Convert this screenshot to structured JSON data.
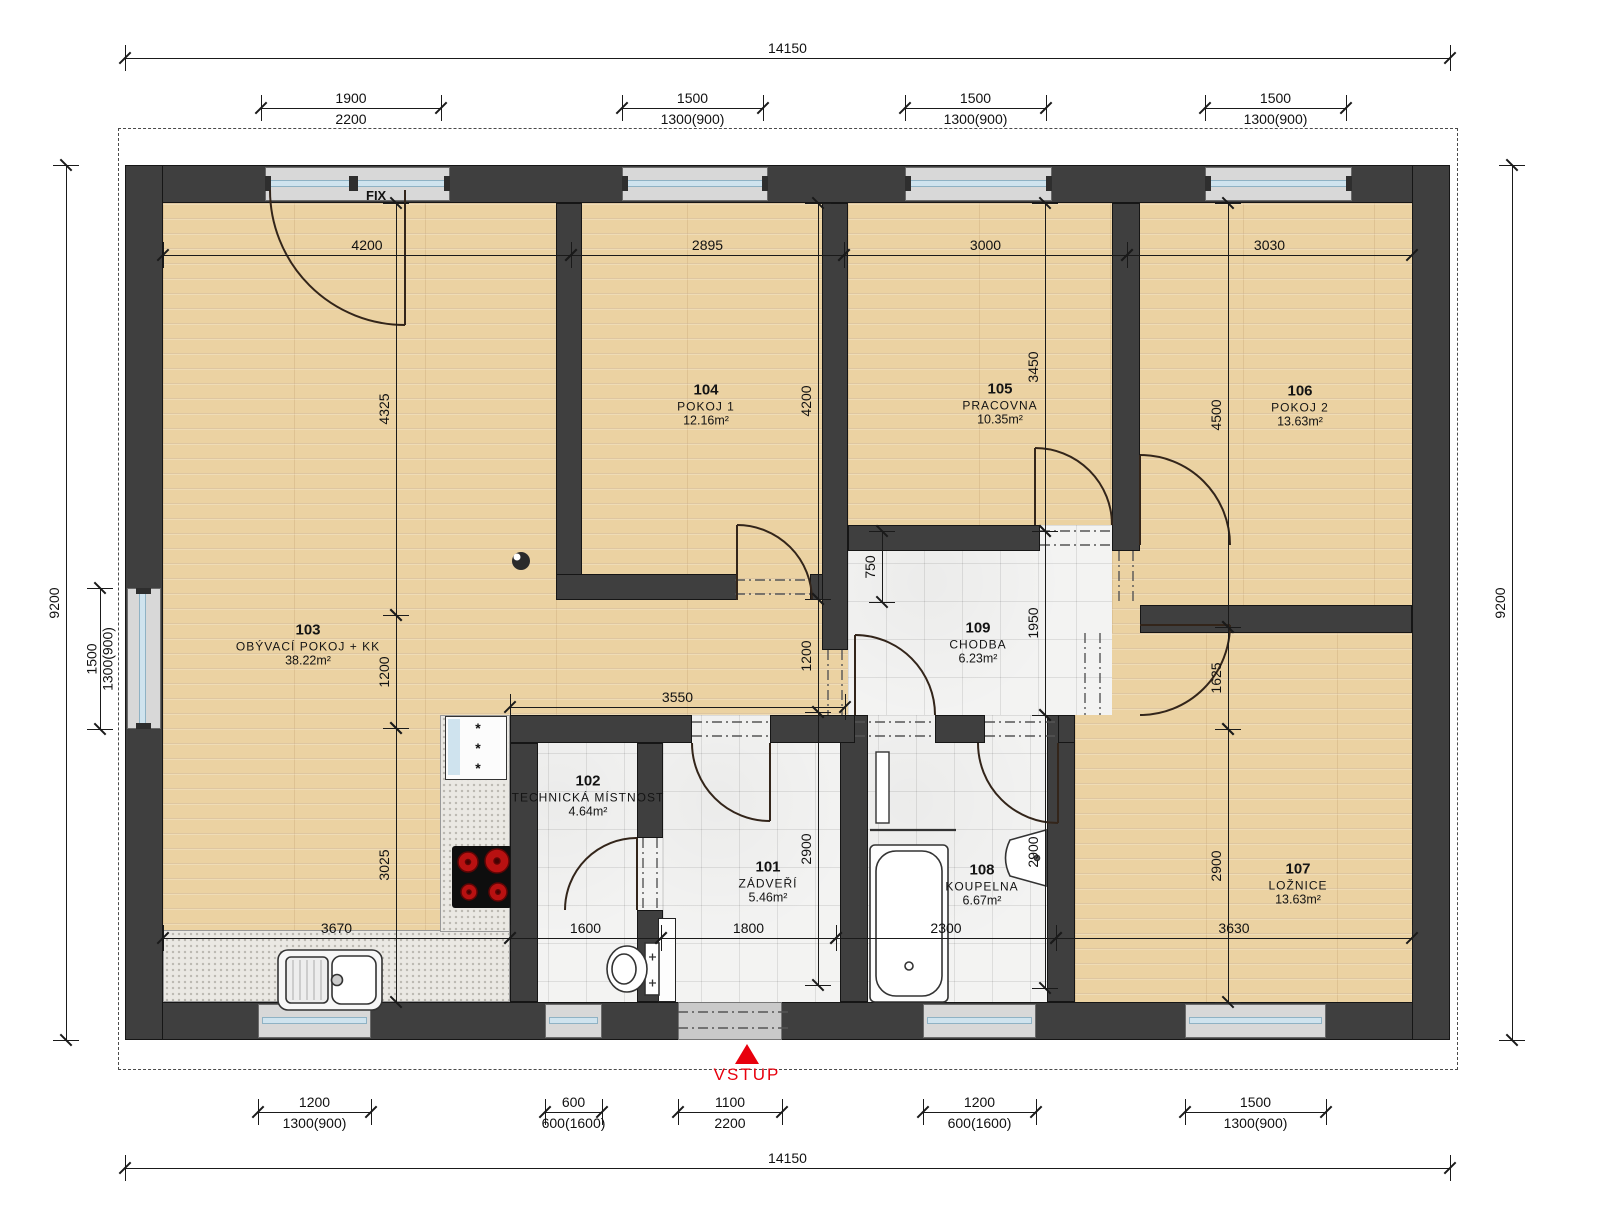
{
  "annotations": {
    "fix": "FIX",
    "vstup": "VSTUP",
    "fridge_symbol": "***"
  },
  "colors": {
    "wall": "#3f3f3f",
    "wood_floor": "#ebd2a2",
    "tile_floor": "#f3f3f2",
    "window_glass": "#cfe3ee",
    "entrance_red": "#e8000d",
    "dimension_text": "#111111"
  },
  "rooms": [
    {
      "num": "101",
      "name": "ZÁDVEŘÍ",
      "area": "5.46m²",
      "x": 768,
      "y": 882
    },
    {
      "num": "102",
      "name": "TECHNICKÁ MÍSTNOST",
      "area": "4.64m²",
      "x": 588,
      "y": 796
    },
    {
      "num": "103",
      "name": "OBÝVACÍ POKOJ + KK",
      "area": "38.22m²",
      "x": 308,
      "y": 645
    },
    {
      "num": "104",
      "name": "POKOJ 1",
      "area": "12.16m²",
      "x": 706,
      "y": 405
    },
    {
      "num": "105",
      "name": "PRACOVNA",
      "area": "10.35m²",
      "x": 1000,
      "y": 404
    },
    {
      "num": "106",
      "name": "POKOJ 2",
      "area": "13.63m²",
      "x": 1300,
      "y": 406
    },
    {
      "num": "107",
      "name": "LOŽNICE",
      "area": "13.63m²",
      "x": 1298,
      "y": 884
    },
    {
      "num": "108",
      "name": "KOUPELNA",
      "area": "6.67m²",
      "x": 982,
      "y": 885
    },
    {
      "num": "109",
      "name": "CHODBA",
      "area": "6.23m²",
      "x": 978,
      "y": 643
    }
  ],
  "dims": [
    {
      "o": "h",
      "x": 125,
      "y": 58,
      "len": 1325,
      "t1": "14150"
    },
    {
      "o": "h",
      "x": 261,
      "y": 108,
      "len": 180,
      "t1": "1900",
      "t2": "2200"
    },
    {
      "o": "h",
      "x": 622,
      "y": 108,
      "len": 141,
      "t1": "1500",
      "t2": "1300(900)"
    },
    {
      "o": "h",
      "x": 905,
      "y": 108,
      "len": 141,
      "t1": "1500",
      "t2": "1300(900)"
    },
    {
      "o": "h",
      "x": 1205,
      "y": 108,
      "len": 141,
      "t1": "1500",
      "t2": "1300(900)"
    },
    {
      "o": "h",
      "x": 163,
      "y": 255,
      "len": 408,
      "t1": "4200"
    },
    {
      "o": "h",
      "x": 571,
      "y": 255,
      "len": 273,
      "t1": "2895"
    },
    {
      "o": "h",
      "x": 844,
      "y": 255,
      "len": 283,
      "t1": "3000"
    },
    {
      "o": "h",
      "x": 1127,
      "y": 255,
      "len": 285,
      "t1": "3030"
    },
    {
      "o": "h",
      "x": 510,
      "y": 707,
      "len": 335,
      "t1": "3550"
    },
    {
      "o": "h",
      "x": 163,
      "y": 938,
      "len": 347,
      "t1": "3670"
    },
    {
      "o": "h",
      "x": 510,
      "y": 938,
      "len": 151,
      "t1": "1600"
    },
    {
      "o": "h",
      "x": 661,
      "y": 938,
      "len": 175,
      "t1": "1800"
    },
    {
      "o": "h",
      "x": 836,
      "y": 938,
      "len": 220,
      "t1": "2300"
    },
    {
      "o": "h",
      "x": 1056,
      "y": 938,
      "len": 356,
      "t1": "3630"
    },
    {
      "o": "h",
      "x": 258,
      "y": 1112,
      "len": 113,
      "t1": "1200",
      "t2": "1300(900)"
    },
    {
      "o": "h",
      "x": 545,
      "y": 1112,
      "len": 57,
      "t1": "600",
      "t2": "600(1600)"
    },
    {
      "o": "h",
      "x": 678,
      "y": 1112,
      "len": 104,
      "t1": "1100",
      "t2": "2200"
    },
    {
      "o": "h",
      "x": 923,
      "y": 1112,
      "len": 113,
      "t1": "1200",
      "t2": "600(1600)"
    },
    {
      "o": "h",
      "x": 1185,
      "y": 1112,
      "len": 141,
      "t1": "1500",
      "t2": "1300(900)"
    },
    {
      "o": "h",
      "x": 125,
      "y": 1168,
      "len": 1325,
      "t1": "14150"
    },
    {
      "o": "v",
      "x": 66,
      "y": 165,
      "len": 875,
      "t1": "9200"
    },
    {
      "o": "v",
      "x": 100,
      "y": 588,
      "len": 141,
      "t1": "1500",
      "t2": "1300(900)"
    },
    {
      "o": "v",
      "x": 396,
      "y": 203,
      "len": 412,
      "t1": "4325"
    },
    {
      "o": "v",
      "x": 818,
      "y": 203,
      "len": 396,
      "t1": "4200"
    },
    {
      "o": "v",
      "x": 1045,
      "y": 203,
      "len": 328,
      "t1": "3450"
    },
    {
      "o": "v",
      "x": 1228,
      "y": 203,
      "len": 424,
      "t1": "4500"
    },
    {
      "o": "v",
      "x": 396,
      "y": 615,
      "len": 113,
      "t1": "1200"
    },
    {
      "o": "v",
      "x": 818,
      "y": 599,
      "len": 113,
      "t1": "1200"
    },
    {
      "o": "v",
      "x": 882,
      "y": 531,
      "len": 71,
      "t1": "750"
    },
    {
      "o": "v",
      "x": 1045,
      "y": 531,
      "len": 184,
      "t1": "1950"
    },
    {
      "o": "v",
      "x": 1228,
      "y": 627,
      "len": 102,
      "t1": "1625"
    },
    {
      "o": "v",
      "x": 818,
      "y": 712,
      "len": 273,
      "t1": "2900"
    },
    {
      "o": "v",
      "x": 1045,
      "y": 715,
      "len": 273,
      "t1": "2900"
    },
    {
      "o": "v",
      "x": 1228,
      "y": 729,
      "len": 273,
      "t1": "2900"
    },
    {
      "o": "v",
      "x": 396,
      "y": 728,
      "len": 274,
      "t1": "3025"
    },
    {
      "o": "v",
      "x": 1512,
      "y": 165,
      "len": 875,
      "t1": "9200"
    }
  ]
}
